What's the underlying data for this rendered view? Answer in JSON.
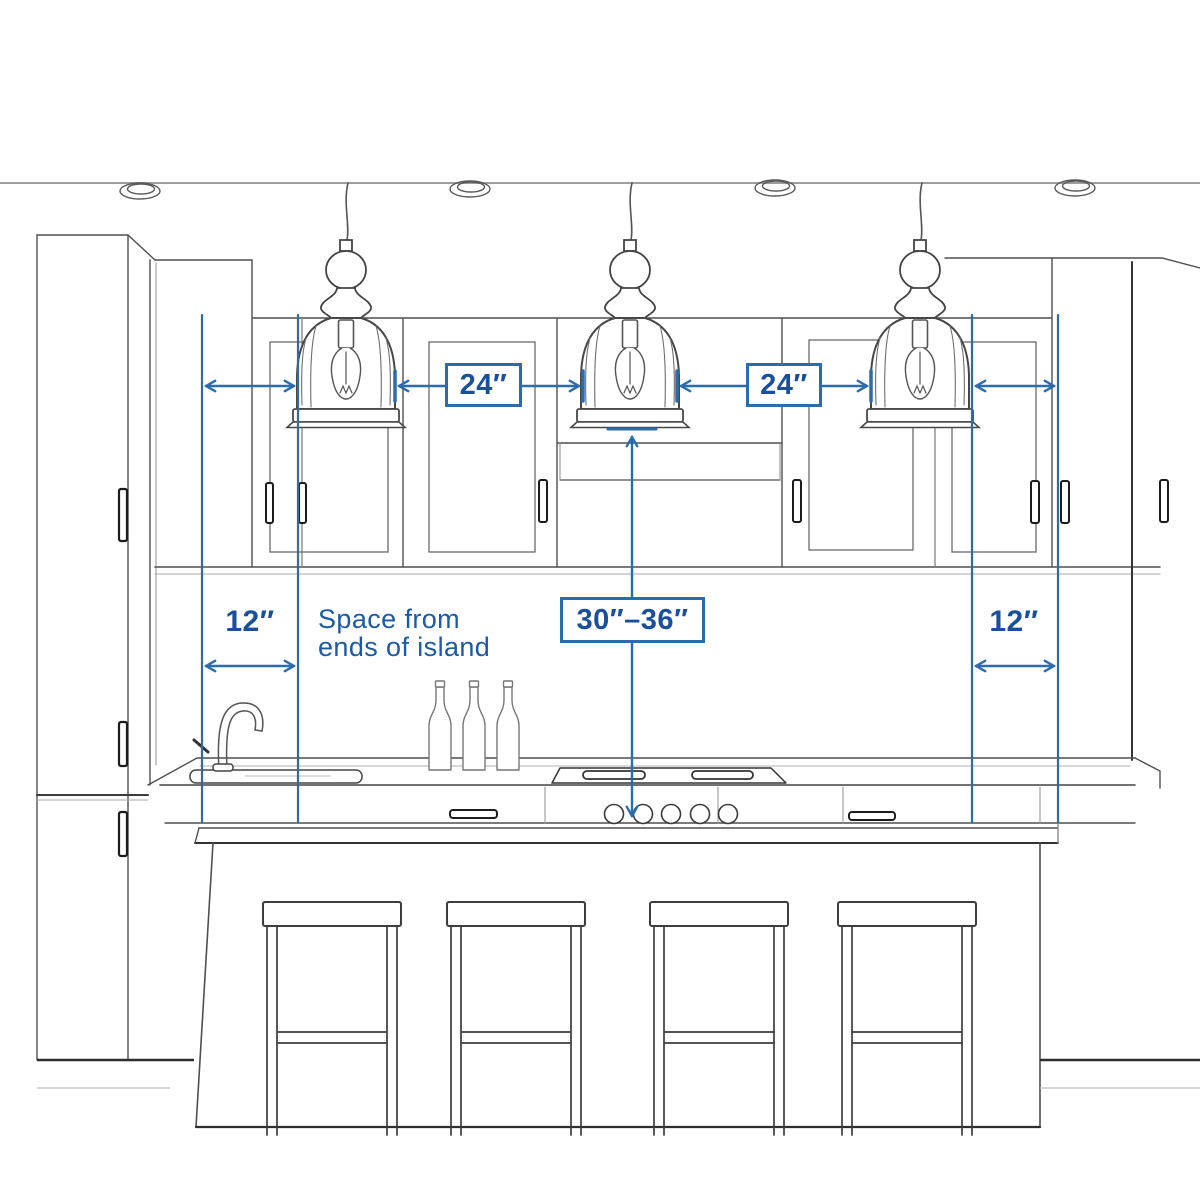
{
  "colors": {
    "background": "#ffffff",
    "annotation_line_blue": "#2b6cad",
    "annotation_text_blue": "#18509e",
    "sketch_line_gray": "#4f4f4f"
  },
  "annotations": {
    "pendant_spacing_left": {
      "label": "24″"
    },
    "pendant_spacing_right": {
      "label": "24″"
    },
    "island_end_space_left": {
      "label": "12″"
    },
    "island_end_space_right": {
      "label": "12″"
    },
    "height_above_counter": {
      "label": "30″–36″"
    },
    "note": {
      "line1": "Space from",
      "line2": "ends of island"
    }
  }
}
